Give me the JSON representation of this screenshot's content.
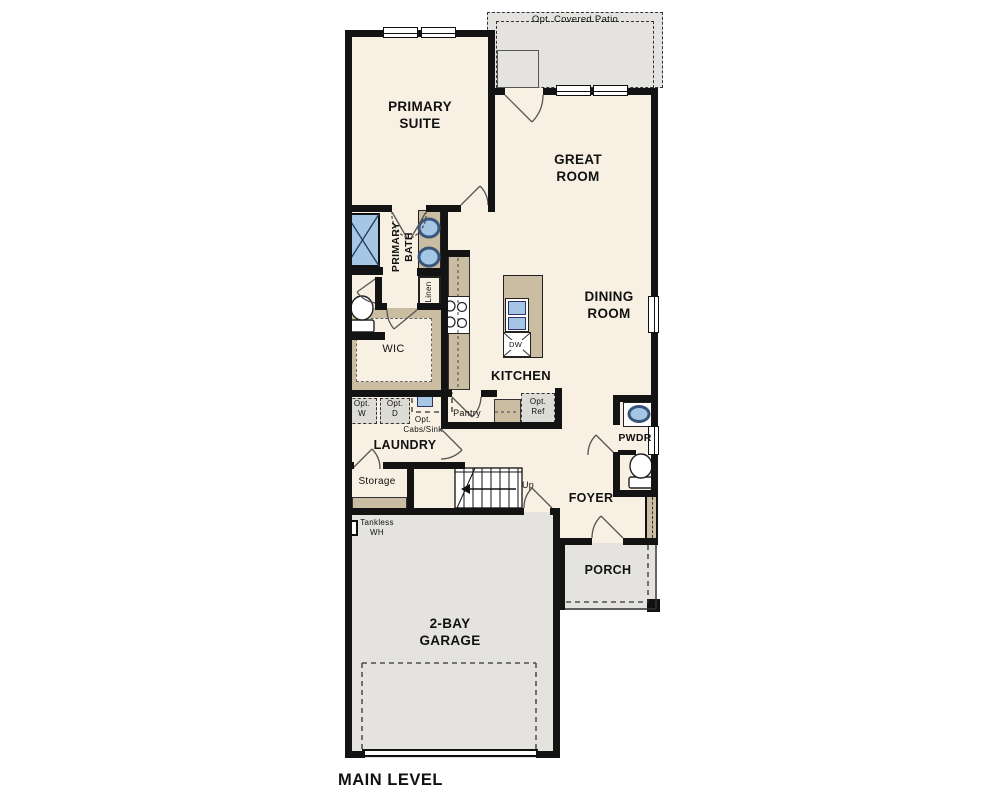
{
  "title": "MAIN LEVEL",
  "colors": {
    "floor": "#f8f1e3",
    "hardscape": "#e4e3e0",
    "cabinet": "#cbbda1",
    "fixture_blue": "#a5c6e5",
    "wall": "#131313"
  },
  "rooms": {
    "primary_suite": "PRIMARY\nSUITE",
    "great_room": "GREAT\nROOM",
    "dining_room": "DINING\nROOM",
    "kitchen": "KITCHEN",
    "primary_bath": "PRIMARY\nBATH",
    "wic": "WIC",
    "laundry": "LAUNDRY",
    "storage": "Storage",
    "pantry": "Pantry",
    "pwdr": "PWDR",
    "foyer": "FOYER",
    "porch": "PORCH",
    "garage": "2-BAY\nGARAGE",
    "patio": "Opt. Covered Patio"
  },
  "features": {
    "linen": "Linen",
    "opt_washer": "Opt.\nW",
    "opt_dryer": "Opt.\nD",
    "opt_cabs_sink": "Opt.\nCabs/Sink",
    "opt_ref": "Opt.\nRef",
    "dishwasher": "DW",
    "stairs_up": "Up",
    "tankless_wh": "Tankless\nWH"
  }
}
